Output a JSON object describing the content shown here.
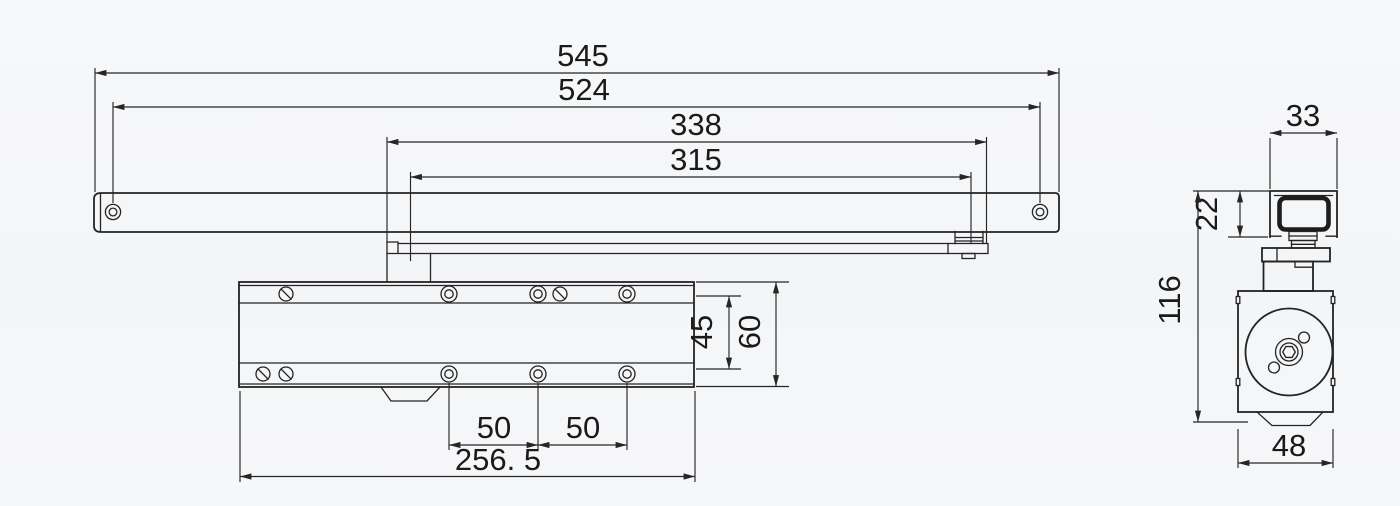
{
  "drawing": {
    "subject": "door-closer-technical-drawing",
    "colors": {
      "line": "#232323",
      "text": "#1a1a1a",
      "background": "#f5f6f8"
    },
    "front_view": {
      "dims": {
        "total_length": "545",
        "hole_span": "524",
        "arm_span": "338",
        "slide_span": "315",
        "hole_pitch_a": "50",
        "hole_pitch_b": "50",
        "body_length": "256. 5",
        "hole_row_spacing": "45",
        "body_height": "60"
      }
    },
    "side_view": {
      "dims": {
        "rail_width": "33",
        "rail_depth": "22",
        "overall_height": "116",
        "body_width": "48"
      }
    }
  }
}
